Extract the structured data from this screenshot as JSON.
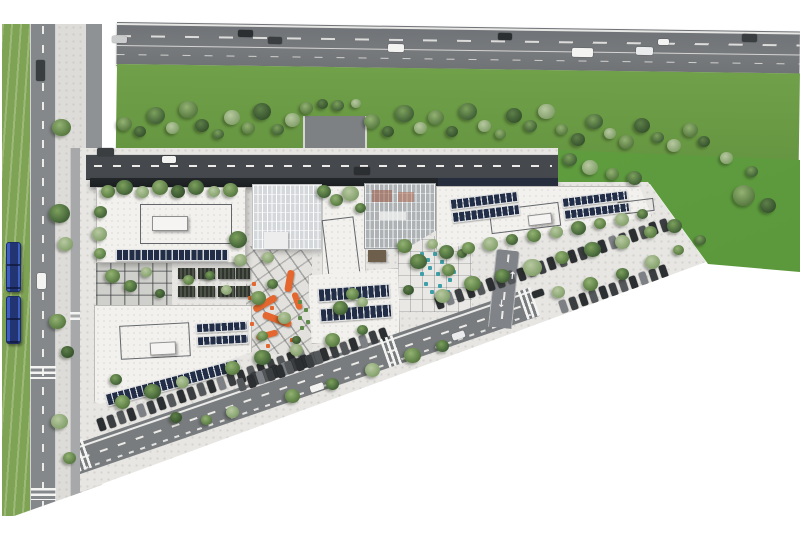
{
  "meta": {
    "title": "Aerial architectural site plan rendering",
    "type": "masterplan-rendering",
    "visible_text": "none"
  },
  "palette": {
    "background": "#ffffff",
    "highway_asphalt": "#74777a",
    "local_asphalt": "#85888b",
    "access_road": "#45484c",
    "canopy_roof": "#1f2326",
    "site_paving": "#e7e6e3",
    "roof_white": "#f2f1ee",
    "solar_panel": "#222d47",
    "verge_green": "#6a9c46",
    "lawn_green": "#5f9c3f",
    "tram_lawn": "#7fa355",
    "orange_accent": "#e06228",
    "teal_seats": "#3f9fa8",
    "tram_blue": "#3d5ec2",
    "marking_white": "#f4f4f3"
  },
  "scene": {
    "regions": {
      "highway": "four-lane highway along top edge with dashed lane lines and vehicles",
      "verge": "tree-planted green buffer between highway and campus",
      "left_corridor": "grass tram corridor with two blue trams, local road, sidewalk and cycle path",
      "campus": "white office buildings with rooftop solar arrays, two glass atria, courtyards, parking rows, perimeter road"
    },
    "render": {
      "car_colors": [
        "#2c2f32",
        "#f3f3f2",
        "#caccce",
        "#3b3e41",
        "#e9ebec",
        "#55585b",
        "#7d8084"
      ],
      "road_cars": [
        [
          112,
          36,
          15,
          7,
          0.8,
          2
        ],
        [
          238,
          30,
          15,
          7,
          0.8,
          0
        ],
        [
          268,
          37,
          14,
          7,
          0.8,
          3
        ],
        [
          388,
          44,
          16,
          8,
          0.8,
          1
        ],
        [
          498,
          33,
          14,
          7,
          0.8,
          0
        ],
        [
          572,
          48,
          21,
          9,
          0.8,
          1
        ],
        [
          636,
          47,
          17,
          8,
          0.8,
          4
        ],
        [
          658,
          39,
          11,
          6,
          0.8,
          1
        ],
        [
          742,
          34,
          15,
          8,
          0.8,
          3
        ],
        [
          162,
          156,
          14,
          7,
          0,
          1
        ],
        [
          97,
          148,
          17,
          8,
          0,
          3
        ],
        [
          354,
          167,
          16,
          8,
          0,
          0
        ],
        [
          36,
          60,
          9,
          21,
          0,
          3
        ],
        [
          37,
          273,
          9,
          16,
          0,
          1
        ],
        [
          310,
          384,
          14,
          7,
          -19,
          1
        ],
        [
          452,
          332,
          13,
          7,
          -19,
          4
        ],
        [
          532,
          290,
          12,
          7,
          -19,
          0
        ]
      ],
      "trams": [
        [
          6,
          242,
          15,
          50
        ],
        [
          6,
          296,
          15,
          48
        ]
      ],
      "parking_rows": [
        [
          98,
          418,
          21,
          10.6,
          -19,
          -19
        ],
        [
          252,
          372,
          14,
          10.4,
          -19,
          -19
        ],
        [
          238,
          378,
          9,
          10.2,
          -19,
          -19
        ],
        [
          436,
          296,
          23,
          10.8,
          -19,
          -19
        ],
        [
          560,
          300,
          11,
          10.6,
          -19,
          -19
        ],
        [
          62,
          196,
          9,
          11,
          90,
          0
        ]
      ],
      "solar_strips": [
        [
          116,
          249,
          112,
          12,
          0
        ],
        [
          450,
          195,
          68,
          11,
          -7
        ],
        [
          452,
          208,
          68,
          11,
          -7
        ],
        [
          562,
          194,
          66,
          10,
          -7
        ],
        [
          564,
          206,
          66,
          10,
          -7
        ],
        [
          318,
          286,
          72,
          14,
          -4
        ],
        [
          320,
          306,
          72,
          14,
          -4
        ],
        [
          196,
          322,
          52,
          10,
          -3
        ],
        [
          197,
          335,
          52,
          10,
          -3
        ],
        [
          104,
          376,
          138,
          13,
          -15
        ]
      ],
      "zebras": [
        [
          74,
          440,
          16,
          30,
          -19,
          "v"
        ],
        [
          384,
          336,
          16,
          30,
          -19,
          "v"
        ],
        [
          522,
          288,
          16,
          30,
          -19,
          "v"
        ],
        [
          30,
          366,
          26,
          13,
          0,
          "h"
        ],
        [
          31,
          488,
          25,
          12,
          0,
          "h"
        ],
        [
          70,
          312,
          13,
          11,
          0,
          "h"
        ]
      ],
      "arrows": [
        [
          508,
          272,
          6,
          "↑"
        ],
        [
          497,
          300,
          6,
          "↓"
        ]
      ],
      "pergolas": [
        [
          178,
          268,
          17,
          11
        ],
        [
          198,
          268,
          17,
          11
        ],
        [
          218,
          268,
          17,
          11
        ],
        [
          236,
          268,
          14,
          11
        ],
        [
          178,
          286,
          17,
          11
        ],
        [
          198,
          286,
          17,
          11
        ],
        [
          218,
          286,
          17,
          11
        ],
        [
          236,
          286,
          14,
          11
        ]
      ],
      "benches": [
        [
          252,
          300,
          26,
          7,
          -30
        ],
        [
          262,
          316,
          30,
          7,
          20
        ],
        [
          256,
          332,
          22,
          6,
          -15
        ],
        [
          286,
          270,
          7,
          22,
          10
        ],
        [
          294,
          292,
          6,
          18,
          -20
        ]
      ],
      "orange_chairs": [
        [
          252,
          282
        ],
        [
          248,
          296
        ],
        [
          270,
          306
        ],
        [
          284,
          322
        ],
        [
          266,
          344
        ],
        [
          290,
          338
        ],
        [
          250,
          322
        ]
      ],
      "green_chairs": [
        [
          298,
          300
        ],
        [
          304,
          308
        ],
        [
          298,
          316
        ],
        [
          306,
          320
        ],
        [
          300,
          326
        ]
      ],
      "teal_seats": [
        [
          420,
          252
        ],
        [
          426,
          258
        ],
        [
          433,
          252
        ],
        [
          440,
          260
        ],
        [
          428,
          266
        ],
        [
          436,
          272
        ],
        [
          444,
          266
        ],
        [
          420,
          272
        ],
        [
          448,
          278
        ],
        [
          438,
          284
        ],
        [
          430,
          290
        ],
        [
          446,
          290
        ],
        [
          452,
          270
        ],
        [
          424,
          282
        ]
      ],
      "trees": [
        [
          124,
          124,
          15,
          1
        ],
        [
          140,
          132,
          12,
          4
        ],
        [
          156,
          116,
          18,
          0
        ],
        [
          172,
          128,
          13,
          2
        ],
        [
          188,
          110,
          19,
          1
        ],
        [
          202,
          126,
          14,
          4
        ],
        [
          218,
          134,
          11,
          0
        ],
        [
          232,
          118,
          16,
          2
        ],
        [
          248,
          128,
          13,
          1
        ],
        [
          262,
          112,
          18,
          4
        ],
        [
          278,
          130,
          12,
          0
        ],
        [
          292,
          120,
          15,
          2
        ],
        [
          306,
          108,
          13,
          1
        ],
        [
          322,
          104,
          11,
          4
        ],
        [
          338,
          106,
          12,
          0
        ],
        [
          356,
          104,
          10,
          2
        ],
        [
          372,
          122,
          16,
          1
        ],
        [
          388,
          132,
          12,
          4
        ],
        [
          404,
          114,
          19,
          0
        ],
        [
          420,
          128,
          13,
          2
        ],
        [
          436,
          118,
          16,
          1
        ],
        [
          452,
          132,
          12,
          4
        ],
        [
          468,
          112,
          18,
          0
        ],
        [
          484,
          126,
          13,
          2
        ],
        [
          500,
          134,
          11,
          1
        ],
        [
          514,
          116,
          16,
          4
        ],
        [
          530,
          126,
          13,
          0
        ],
        [
          546,
          112,
          17,
          2
        ],
        [
          562,
          130,
          12,
          1
        ],
        [
          578,
          140,
          14,
          4
        ],
        [
          594,
          122,
          17,
          0
        ],
        [
          610,
          134,
          12,
          2
        ],
        [
          626,
          142,
          15,
          1
        ],
        [
          642,
          126,
          16,
          4
        ],
        [
          658,
          138,
          12,
          0
        ],
        [
          674,
          146,
          14,
          2
        ],
        [
          690,
          130,
          15,
          1
        ],
        [
          704,
          142,
          12,
          4
        ],
        [
          570,
          160,
          14,
          0
        ],
        [
          590,
          168,
          16,
          2
        ],
        [
          612,
          174,
          13,
          1
        ],
        [
          634,
          178,
          15,
          0
        ],
        [
          726,
          158,
          13,
          2
        ],
        [
          744,
          196,
          22,
          1
        ],
        [
          768,
          206,
          16,
          4
        ],
        [
          752,
          172,
          12,
          0
        ],
        [
          61,
          128,
          19,
          1
        ],
        [
          59,
          214,
          21,
          0
        ],
        [
          65,
          244,
          15,
          2
        ],
        [
          57,
          322,
          17,
          1
        ],
        [
          67,
          352,
          13,
          4
        ],
        [
          59,
          422,
          17,
          2
        ],
        [
          69,
          458,
          13,
          1
        ],
        [
          108,
          192,
          14,
          1
        ],
        [
          124,
          188,
          17,
          0
        ],
        [
          142,
          192,
          13,
          2
        ],
        [
          160,
          188,
          16,
          1
        ],
        [
          178,
          192,
          14,
          4
        ],
        [
          196,
          188,
          16,
          0
        ],
        [
          214,
          192,
          12,
          2
        ],
        [
          230,
          190,
          15,
          1
        ],
        [
          100,
          212,
          13,
          0
        ],
        [
          99,
          234,
          15,
          2
        ],
        [
          100,
          254,
          12,
          1
        ],
        [
          238,
          240,
          18,
          0
        ],
        [
          240,
          260,
          13,
          2
        ],
        [
          112,
          276,
          15,
          1
        ],
        [
          130,
          286,
          13,
          0
        ],
        [
          146,
          272,
          11,
          2
        ],
        [
          188,
          280,
          11,
          1
        ],
        [
          210,
          276,
          10,
          0
        ],
        [
          226,
          290,
          11,
          2
        ],
        [
          160,
          294,
          10,
          4
        ],
        [
          258,
          298,
          15,
          1
        ],
        [
          272,
          284,
          11,
          0
        ],
        [
          284,
          318,
          13,
          2
        ],
        [
          262,
          336,
          11,
          1
        ],
        [
          296,
          340,
          9,
          4
        ],
        [
          268,
          258,
          12,
          2
        ],
        [
          324,
          192,
          14,
          0
        ],
        [
          336,
          200,
          13,
          1
        ],
        [
          350,
          194,
          17,
          2
        ],
        [
          360,
          208,
          11,
          0
        ],
        [
          352,
          294,
          13,
          1
        ],
        [
          340,
          308,
          15,
          0
        ],
        [
          362,
          302,
          11,
          2
        ],
        [
          404,
          246,
          15,
          1
        ],
        [
          418,
          262,
          17,
          0
        ],
        [
          432,
          244,
          11,
          2
        ],
        [
          448,
          270,
          13,
          1
        ],
        [
          408,
          290,
          11,
          4
        ],
        [
          442,
          296,
          15,
          2
        ],
        [
          462,
          254,
          10,
          0
        ],
        [
          446,
          252,
          15,
          0
        ],
        [
          468,
          248,
          13,
          1
        ],
        [
          490,
          244,
          15,
          2
        ],
        [
          512,
          240,
          12,
          0
        ],
        [
          534,
          236,
          14,
          1
        ],
        [
          556,
          232,
          13,
          2
        ],
        [
          578,
          228,
          15,
          0
        ],
        [
          600,
          224,
          12,
          1
        ],
        [
          622,
          220,
          14,
          2
        ],
        [
          642,
          214,
          11,
          0
        ],
        [
          472,
          284,
          17,
          1
        ],
        [
          502,
          276,
          15,
          0
        ],
        [
          532,
          268,
          19,
          2
        ],
        [
          562,
          258,
          14,
          1
        ],
        [
          592,
          250,
          17,
          0
        ],
        [
          622,
          242,
          15,
          2
        ],
        [
          650,
          232,
          13,
          1
        ],
        [
          674,
          226,
          15,
          0
        ],
        [
          558,
          292,
          13,
          2
        ],
        [
          590,
          284,
          15,
          1
        ],
        [
          622,
          274,
          13,
          0
        ],
        [
          652,
          262,
          15,
          2
        ],
        [
          678,
          250,
          11,
          1
        ],
        [
          700,
          240,
          11,
          0
        ],
        [
          122,
          402,
          15,
          1
        ],
        [
          152,
          392,
          17,
          0
        ],
        [
          182,
          382,
          13,
          2
        ],
        [
          232,
          368,
          15,
          1
        ],
        [
          262,
          358,
          17,
          0
        ],
        [
          296,
          350,
          13,
          2
        ],
        [
          332,
          340,
          15,
          1
        ],
        [
          362,
          330,
          11,
          0
        ],
        [
          232,
          412,
          13,
          2
        ],
        [
          292,
          396,
          15,
          1
        ],
        [
          332,
          384,
          13,
          0
        ],
        [
          372,
          370,
          15,
          2
        ],
        [
          412,
          356,
          17,
          1
        ],
        [
          442,
          346,
          13,
          0
        ],
        [
          206,
          420,
          11,
          1
        ],
        [
          176,
          418,
          12,
          4
        ],
        [
          116,
          380,
          12,
          0
        ]
      ]
    }
  }
}
